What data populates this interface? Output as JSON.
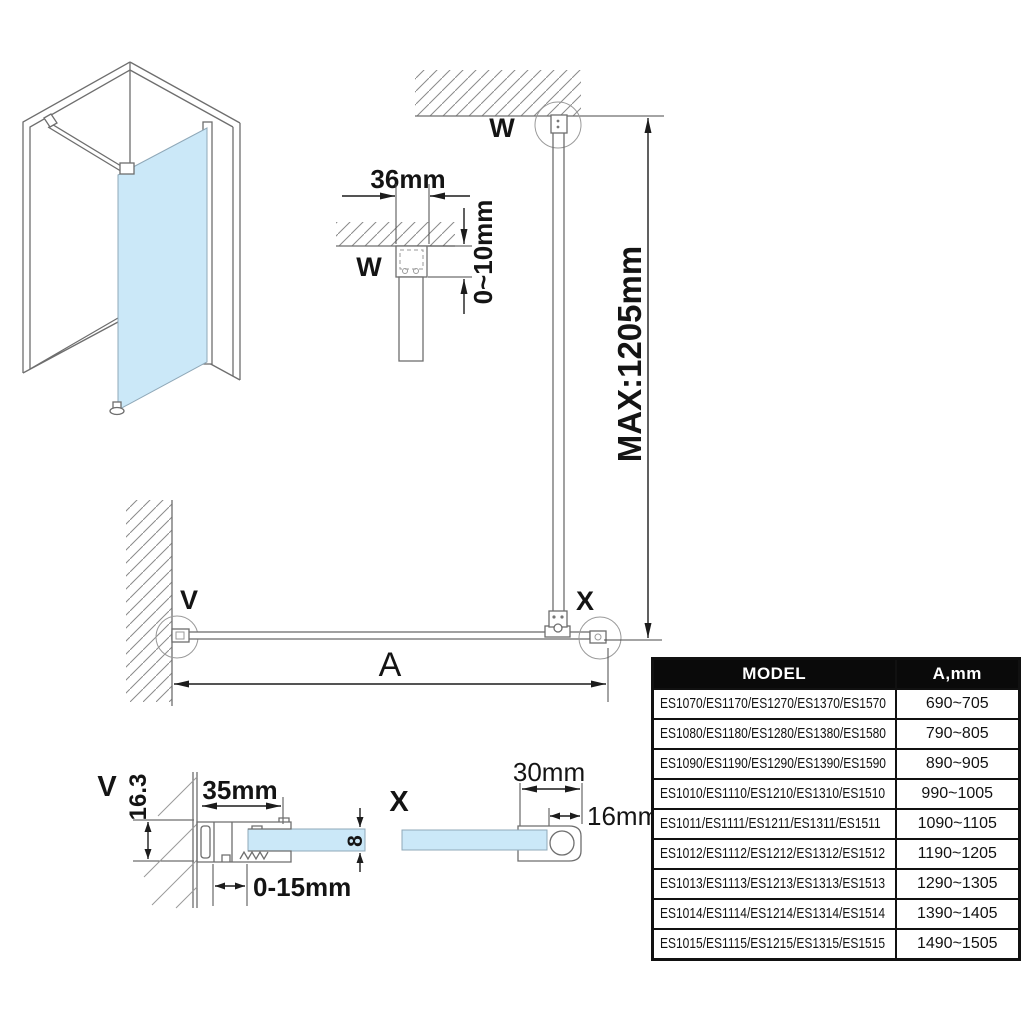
{
  "colors": {
    "bg": "#FFFFFF",
    "glass": "#CBE8F8",
    "line": "#6E6E6E",
    "thin": "#9A9A9A",
    "dim": "#1C1C1C",
    "table_header_bg": "#0A0A0A",
    "table_header_text": "#FFFFFF",
    "table_border": "#111111"
  },
  "labels": {
    "detail_w": {
      "title": "W",
      "width": "36mm",
      "gap": "0~10mm"
    },
    "elevation": {
      "wall_ref": "W",
      "max_height": "MAX:1205mm",
      "end_ref": "X"
    },
    "plan": {
      "wall_ref": "V",
      "width": "A"
    },
    "detail_v": {
      "title": "V",
      "depth": "16.3",
      "width": "35mm",
      "glass_thickness": "8",
      "adjustment": "0-15mm"
    },
    "detail_x": {
      "title": "X",
      "width": "30mm",
      "bar": "16mm"
    }
  },
  "table": {
    "headers": [
      "MODEL",
      "A,mm"
    ],
    "rows": [
      {
        "model": "ES1070/ES1170/ES1270/ES1370/ES1570",
        "a": "690~705"
      },
      {
        "model": "ES1080/ES1180/ES1280/ES1380/ES1580",
        "a": "790~805"
      },
      {
        "model": "ES1090/ES1190/ES1290/ES1390/ES1590",
        "a": "890~905"
      },
      {
        "model": "ES1010/ES1110/ES1210/ES1310/ES1510",
        "a": "990~1005"
      },
      {
        "model": "ES1011/ES1111/ES1211/ES1311/ES1511",
        "a": "1090~1105"
      },
      {
        "model": "ES1012/ES1112/ES1212/ES1312/ES1512",
        "a": "1190~1205"
      },
      {
        "model": "ES1013/ES1113/ES1213/ES1313/ES1513",
        "a": "1290~1305"
      },
      {
        "model": "ES1014/ES1114/ES1214/ES1314/ES1514",
        "a": "1390~1405"
      },
      {
        "model": "ES1015/ES1115/ES1215/ES1315/ES1515",
        "a": "1490~1505"
      }
    ]
  }
}
